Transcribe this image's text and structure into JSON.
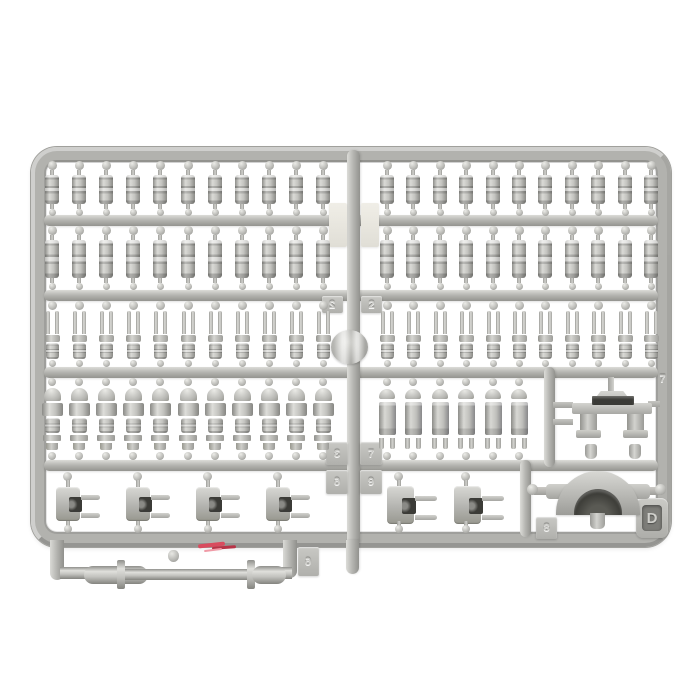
{
  "scene": {
    "description": "Photo of a light gray injection-molded plastic model kit sprue (parts runner) on a white background",
    "background_color": "#ffffff"
  },
  "sprue": {
    "plate_letter": "D",
    "plastic_color": "#c4c4c0",
    "runner_color": "#b2b2ae",
    "highlight_color": "#e9e9e5",
    "shadow_color": "#8e8e8a",
    "slot_color": "#3b3b37",
    "paint_mark_color": "#d94b5e",
    "tabs": {
      "row12_left": "",
      "row12_right": "",
      "row23_left": "2",
      "row23_right": "2",
      "cross_tl": "3",
      "cross_tr": "7",
      "cross_bl": "6",
      "cross_br": "9",
      "section_bracket": "7",
      "section_uclamp": "8",
      "below_rail": "6"
    },
    "rows": [
      {
        "name": "small pin parts row 1",
        "part": "pin",
        "left_count": 11,
        "right_count": 11
      },
      {
        "name": "small pin parts row 2",
        "part": "pin",
        "left_count": 11,
        "right_count": 11
      },
      {
        "name": "fork pin parts row 3",
        "part": "fork",
        "left_count": 11,
        "right_count": 11
      },
      {
        "name": "damper cylinder parts row 4",
        "part": "damper",
        "left_count": 11,
        "right_count": 6
      },
      {
        "name": "clevis shackle parts row 5",
        "part": "clevis",
        "left_count": 4,
        "right_count": 2
      }
    ],
    "special_parts": [
      "mounting bracket with slot (section 7)",
      "semicircular U-clamp saddle (section 8)",
      "long rod with end sleeves and two flanges (below bottom rail)"
    ],
    "details": {
      "gate": "round injection gate boss on center runner",
      "red_paint_mark": "small red scratch mark on bottom rail"
    }
  }
}
